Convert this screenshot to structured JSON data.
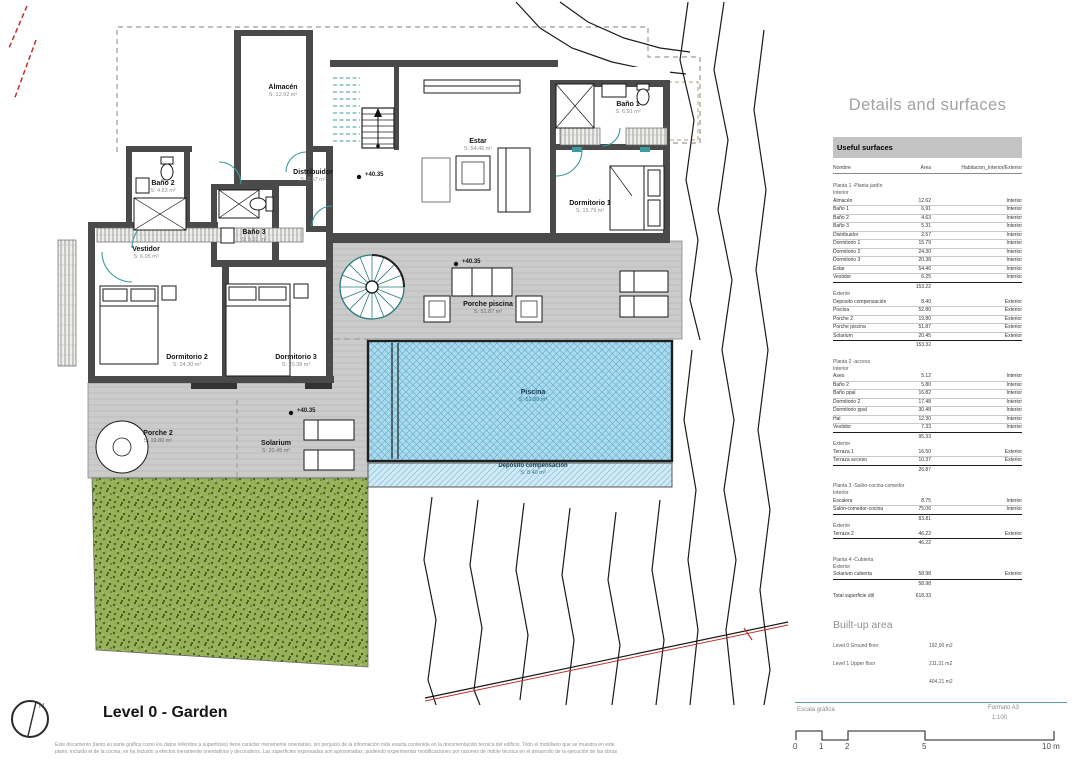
{
  "panel": {
    "title": "Details and surfaces",
    "table_header": "Useful surfaces",
    "columns": [
      "Nombre",
      "Área",
      "Habitacion_Interior/Exterior"
    ],
    "sections": [
      {
        "group": "Planta 1 -Planta jardín",
        "blocks": [
          {
            "label": "Interior",
            "rows": [
              [
                "Almacén",
                "12.62",
                "Interior"
              ],
              [
                "Baño 1",
                "6.91",
                "Interior"
              ],
              [
                "Baño 2",
                "4.63",
                "Interior"
              ],
              [
                "Baño 3",
                "5.31",
                "Interior"
              ],
              [
                "Distribuidor",
                "2.57",
                "Interior"
              ],
              [
                "Dormitorio 1",
                "15.79",
                "Interior"
              ],
              [
                "Dormitorio 2",
                "24.30",
                "Interior"
              ],
              [
                "Dormitorio 3",
                "20.38",
                "Interior"
              ],
              [
                "Estar",
                "54.46",
                "Interior"
              ],
              [
                "Vestidor",
                "6.25",
                "Interior"
              ]
            ],
            "subtotal": "153.22"
          },
          {
            "label": "Exterior",
            "rows": [
              [
                "Deposito compensación",
                "8.40",
                "Exterior"
              ],
              [
                "Piscina",
                "52.80",
                "Exterior"
              ],
              [
                "Porche 2",
                "19.80",
                "Exterior"
              ],
              [
                "Porche piscina",
                "51.87",
                "Exterior"
              ],
              [
                "Solarium",
                "20.45",
                "Exterior"
              ]
            ],
            "subtotal": "153.32"
          }
        ]
      },
      {
        "group": "Planta 2 -acceso",
        "blocks": [
          {
            "label": "Interior",
            "rows": [
              [
                "Aseo",
                "5.12",
                "Interior"
              ],
              [
                "Baño 2",
                "5.80",
                "Interior"
              ],
              [
                "Baño ppal",
                "16.82",
                "Interior"
              ],
              [
                "Dormitorio 2",
                "17.48",
                "Interior"
              ],
              [
                "Dormitorio ppal",
                "30.48",
                "Interior"
              ],
              [
                "Hal",
                "12.30",
                "Interior"
              ],
              [
                "Vestidor",
                "7.33",
                "Interior"
              ]
            ],
            "subtotal": "95.33"
          },
          {
            "label": "Exterior",
            "rows": [
              [
                "Terraza 1",
                "16.50",
                "Exterior"
              ],
              [
                "Terraza acceso",
                "10.37",
                "Exterior"
              ]
            ],
            "subtotal": "26.87"
          }
        ]
      },
      {
        "group": "Planta 3 -Salón-cocina-comedor",
        "blocks": [
          {
            "label": "Interior",
            "rows": [
              [
                "Escalera",
                "8.75",
                "Interior"
              ],
              [
                "Salón-comedor-cocina",
                "75.06",
                "Interior"
              ]
            ],
            "subtotal": "83.81"
          },
          {
            "label": "Exterior",
            "rows": [
              [
                "Terraza 2",
                "46.22",
                "Exterior"
              ]
            ],
            "subtotal": "46.22"
          }
        ]
      },
      {
        "group": "Planta 4 -Cubierta",
        "blocks": [
          {
            "label": "Exterior",
            "rows": [
              [
                "Solarium cubierta",
                "58.98",
                "Exterior"
              ]
            ],
            "subtotal": "58.98"
          }
        ]
      }
    ],
    "total_label": "Total superficie útil",
    "total_value": "618.33",
    "built_up": {
      "title": "Built-up area",
      "rows": [
        [
          "Level 0 Ground floor",
          "192,90 m2"
        ],
        [
          "Level 1 Upper floor",
          "211,31 m2"
        ]
      ],
      "total": "404,21 m2"
    }
  },
  "plan": {
    "title": "Level 0 - Garden",
    "elevation_label": "+40.35",
    "elevations": [
      {
        "x": 365,
        "y": 172
      },
      {
        "x": 462,
        "y": 259
      },
      {
        "x": 297,
        "y": 408
      }
    ],
    "rooms": [
      {
        "name": "Almacén",
        "area": "S: 12.92 m²",
        "x": 283,
        "y": 84,
        "cls": ""
      },
      {
        "name": "Estar",
        "area": "S: 54.46 m²",
        "x": 478,
        "y": 138,
        "cls": ""
      },
      {
        "name": "Baño 1",
        "area": "S: 6.91 m²",
        "x": 628,
        "y": 101,
        "cls": ""
      },
      {
        "name": "Dormitorio 1",
        "area": "S: 15.79 m²",
        "x": 590,
        "y": 200,
        "cls": ""
      },
      {
        "name": "Baño 2",
        "area": "S: 4.63 m²",
        "x": 163,
        "y": 180,
        "cls": ""
      },
      {
        "name": "Distribuidor",
        "area": "S: 2.57 m²",
        "x": 313,
        "y": 169,
        "cls": ""
      },
      {
        "name": "Baño 3",
        "area": "S: 5.31 m²",
        "x": 254,
        "y": 229,
        "cls": ""
      },
      {
        "name": "Vestidor",
        "area": "S: 6.05 m²",
        "x": 146,
        "y": 246,
        "cls": ""
      },
      {
        "name": "Dormitorio 2",
        "area": "S: 24.30 m²",
        "x": 187,
        "y": 354,
        "cls": ""
      },
      {
        "name": "Dormitorio 3",
        "area": "S: 20.38 m²",
        "x": 296,
        "y": 354,
        "cls": ""
      },
      {
        "name": "Porche piscina",
        "area": "S: 51.87 m²",
        "x": 488,
        "y": 301,
        "cls": "deck"
      },
      {
        "name": "Piscina",
        "area": "S: 52.80 m²",
        "x": 533,
        "y": 389,
        "cls": "pool"
      },
      {
        "name": "Deposito compensación",
        "area": "S: 8.40 m²",
        "x": 533,
        "y": 463,
        "cls": "depo"
      },
      {
        "name": "Porche 2",
        "area": "S: 19.80 m²",
        "x": 158,
        "y": 430,
        "cls": "deck"
      },
      {
        "name": "Solarium",
        "area": "S: 20.45 m²",
        "x": 276,
        "y": 440,
        "cls": "deck"
      }
    ]
  },
  "footer": {
    "disclaimer_line1": "Este documento (tanto su parte gráfica como los datos referidos a superficies) tiene carácter meramente orientativo, sin perjuicio de la información más exacta contenida en la documentación técnica del edificio. Todo el mobiliario que se muestra en este",
    "disclaimer_line2": "plano, incluido el de la cocina, se ha incluido a efectos meramente orientativos y decorativos. Las superficies expresadas son aproximadas, pudiendo experimentar modificaciones por razones de índole técnica en el desarrollo de la ejecución de las obras",
    "north_label": "N"
  },
  "scale": {
    "caption": "Escala gráfica",
    "format": "Formato A3",
    "ratio": "1:100",
    "ticks": [
      "0",
      "1",
      "2",
      "5",
      "10 m"
    ]
  },
  "colors": {
    "accent_teal": "#3a9ba0",
    "pool_blue": "#aeddef",
    "garden_green": "#97b159",
    "deck_gray": "#cbcbcb",
    "wall_gray": "#4a4a4a",
    "boundary_red": "#c03030"
  }
}
